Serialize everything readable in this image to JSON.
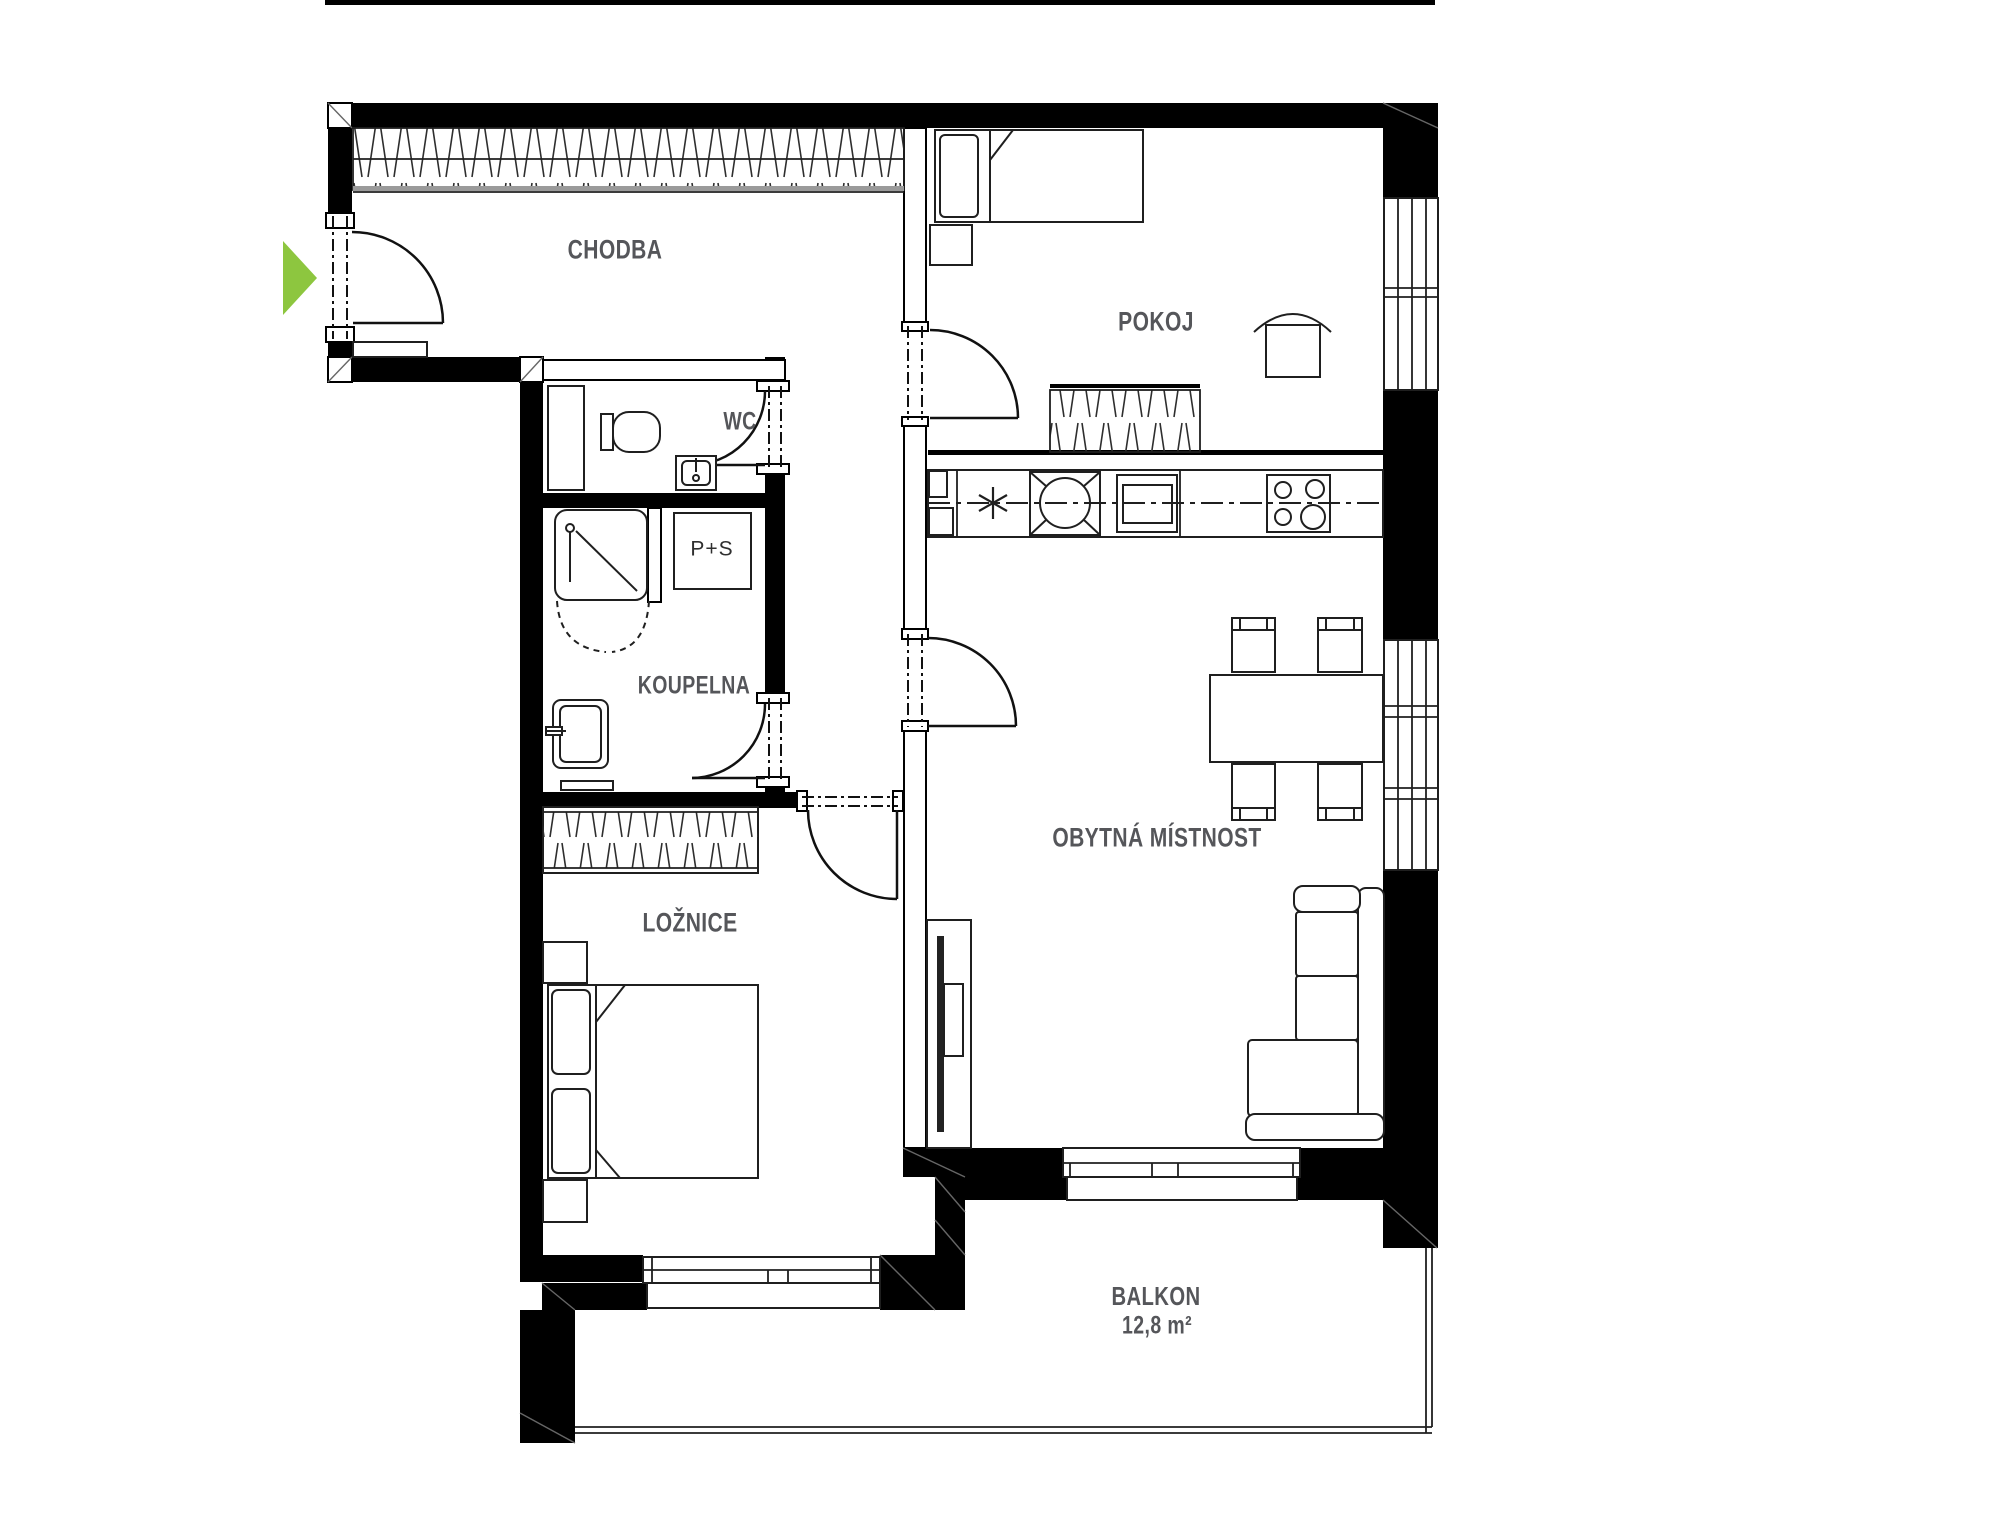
{
  "rooms": {
    "chodba": {
      "label": "CHODBA"
    },
    "pokoj": {
      "label": "POKOJ"
    },
    "wc": {
      "label": "WC"
    },
    "koupelna": {
      "label": "KOUPELNA"
    },
    "loznice": {
      "label": "LOŽNICE"
    },
    "obytna_mistnost": {
      "label": "OBYTNÁ MÍSTNOST"
    },
    "balkon": {
      "label": "BALKON",
      "area": "12,8 m²"
    }
  },
  "appliances": {
    "washer_dryer": "P+S"
  },
  "entrance": {
    "marker_color": "#8dc63f"
  },
  "colors": {
    "wall": "#000000",
    "line": "#1f1f1f",
    "label": "#55565a",
    "accent_green": "#8dc63f"
  }
}
